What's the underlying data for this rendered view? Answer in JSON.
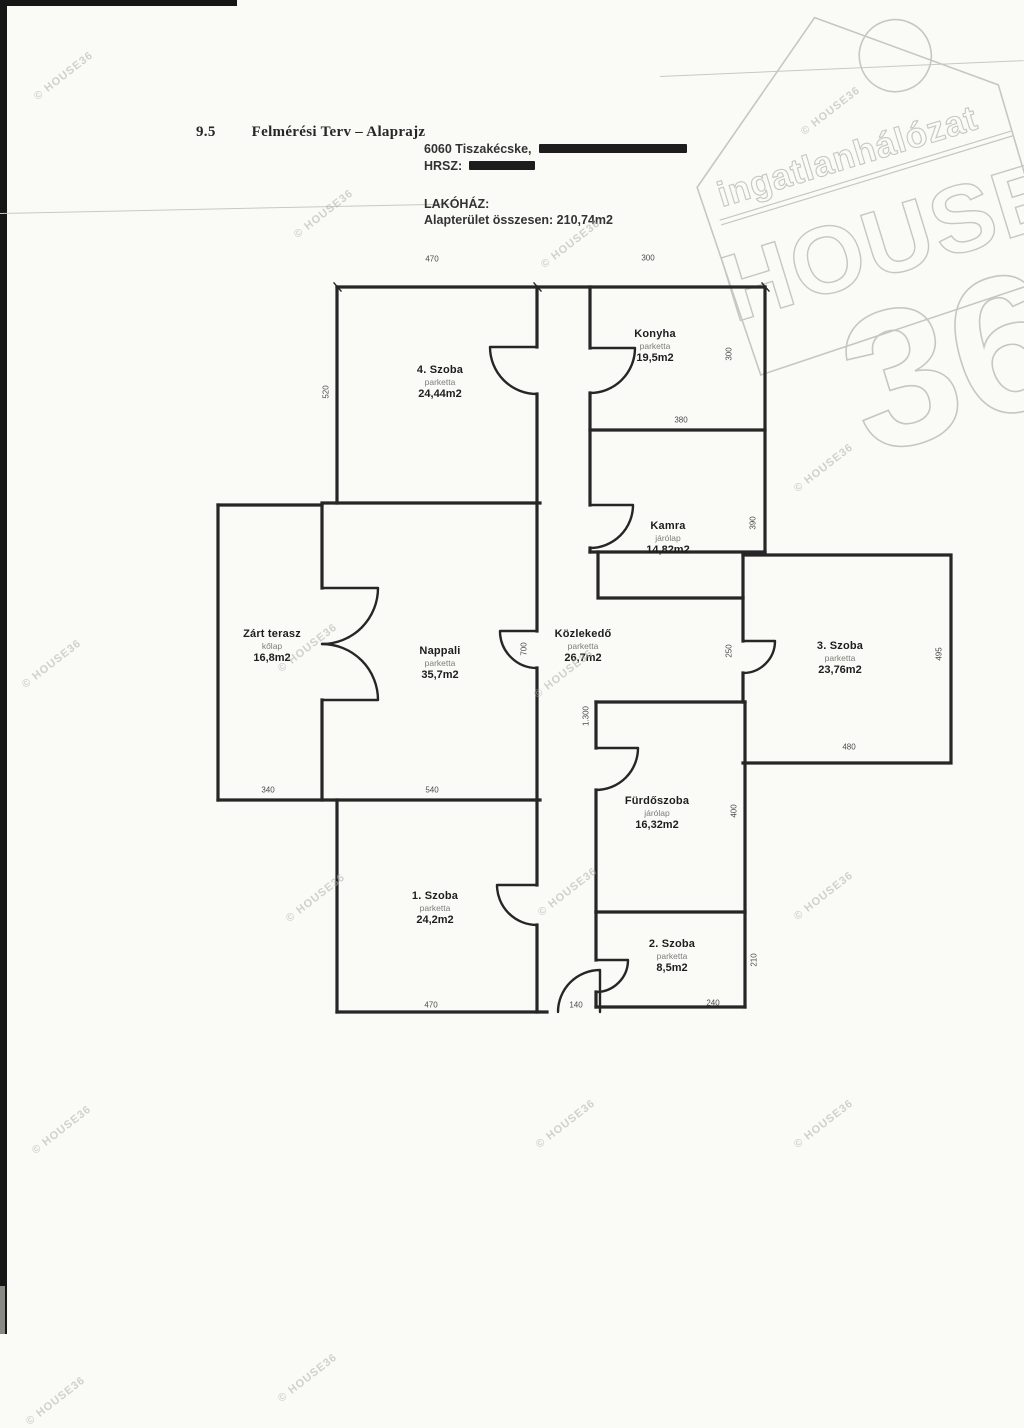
{
  "page": {
    "section_number": "9.5",
    "section_title": "Felmérési Terv – Alaprajz",
    "address_city": "6060 Tiszakécske,",
    "hrsz_label": "HRSZ:",
    "building_label": "LAKÓHÁZ:",
    "total_area_line": "Alapterület összesen: 210,74m2"
  },
  "logo": {
    "brand_top": "ingatlanhálózat",
    "brand_main": "HOUSE",
    "brand_number": "36"
  },
  "watermark_text": "© HOUSE36",
  "rooms": [
    {
      "name": "4. Szoba",
      "floor": "parketta",
      "area": "24,44m2"
    },
    {
      "name": "Konyha",
      "floor": "parketta",
      "area": "19,5m2"
    },
    {
      "name": "Kamra",
      "floor": "járólap",
      "area": "14,82m2"
    },
    {
      "name": "Zárt terasz",
      "floor": "kőlap",
      "area": "16,8m2"
    },
    {
      "name": "Nappali",
      "floor": "parketta",
      "area": "35,7m2"
    },
    {
      "name": "Közlekedő",
      "floor": "parketta",
      "area": "26,7m2"
    },
    {
      "name": "3. Szoba",
      "floor": "parketta",
      "area": "23,76m2"
    },
    {
      "name": "Fürdőszoba",
      "floor": "járólap",
      "area": "16,32m2"
    },
    {
      "name": "1. Szoba",
      "floor": "parketta",
      "area": "24,2m2"
    },
    {
      "name": "2. Szoba",
      "floor": "parketta",
      "area": "8,5m2"
    }
  ],
  "dims": {
    "top_left": "470",
    "top_right": "300",
    "szoba4_left": "520",
    "konyha_bottom": "380",
    "konyha_side": "300",
    "kamra_side": "390",
    "terasz_bottom": "340",
    "nappali_bottom": "540",
    "nappali_door": "700",
    "corridor": "1.300",
    "szoba3_door": "250",
    "szoba3_side": "495",
    "szoba3_bottom": "480",
    "furdo_side": "400",
    "szoba1_bottom": "470",
    "exit_door": "140",
    "szoba2_bottom": "240",
    "szoba2_side": "210"
  }
}
